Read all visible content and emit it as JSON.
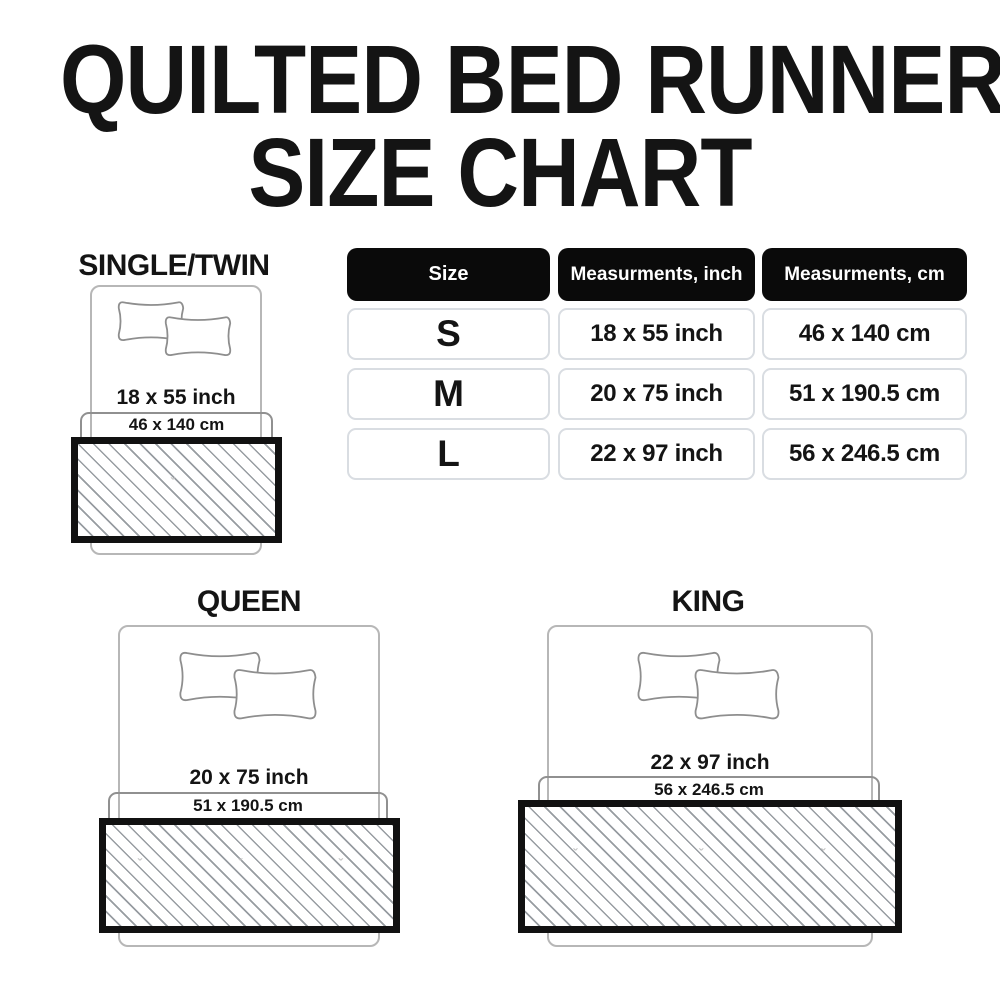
{
  "title": {
    "line1": "QUILTED BED RUNNER",
    "line2": "SIZE CHART"
  },
  "table": {
    "headers": [
      "Size",
      "Measurments, inch",
      "Measurments, cm"
    ],
    "rows": [
      {
        "size": "S",
        "inch": "18 x 55 inch",
        "cm": "46 x 140 cm"
      },
      {
        "size": "M",
        "inch": "20 x 75 inch",
        "cm": "51 x 190.5 cm"
      },
      {
        "size": "L",
        "inch": "22 x 97 inch",
        "cm": "56 x 246.5 cm"
      }
    ]
  },
  "diagrams": [
    {
      "name": "SINGLE/TWIN",
      "inch": "18 x 55 inch",
      "cm": "46 x 140 cm"
    },
    {
      "name": "QUEEN",
      "inch": "20 x 75 inch",
      "cm": "51 x 190.5 cm"
    },
    {
      "name": "KING",
      "inch": "22 x 97 inch",
      "cm": "56 x 246.5 cm"
    }
  ],
  "icons": {
    "pillow": "pillow-icon",
    "bed": "bed-outline",
    "runner": "bed-runner-hatch-swatch"
  },
  "colors": {
    "background": "#ffffff",
    "ink": "#141414",
    "accent": "#0a0a0a",
    "cell_border": "#d9dde2",
    "outline": "#b7b7b7",
    "bracket": "#909090",
    "pillow_stroke": "#8e8e8e",
    "runner_border": "#111111",
    "hatch": "#979ca1"
  }
}
